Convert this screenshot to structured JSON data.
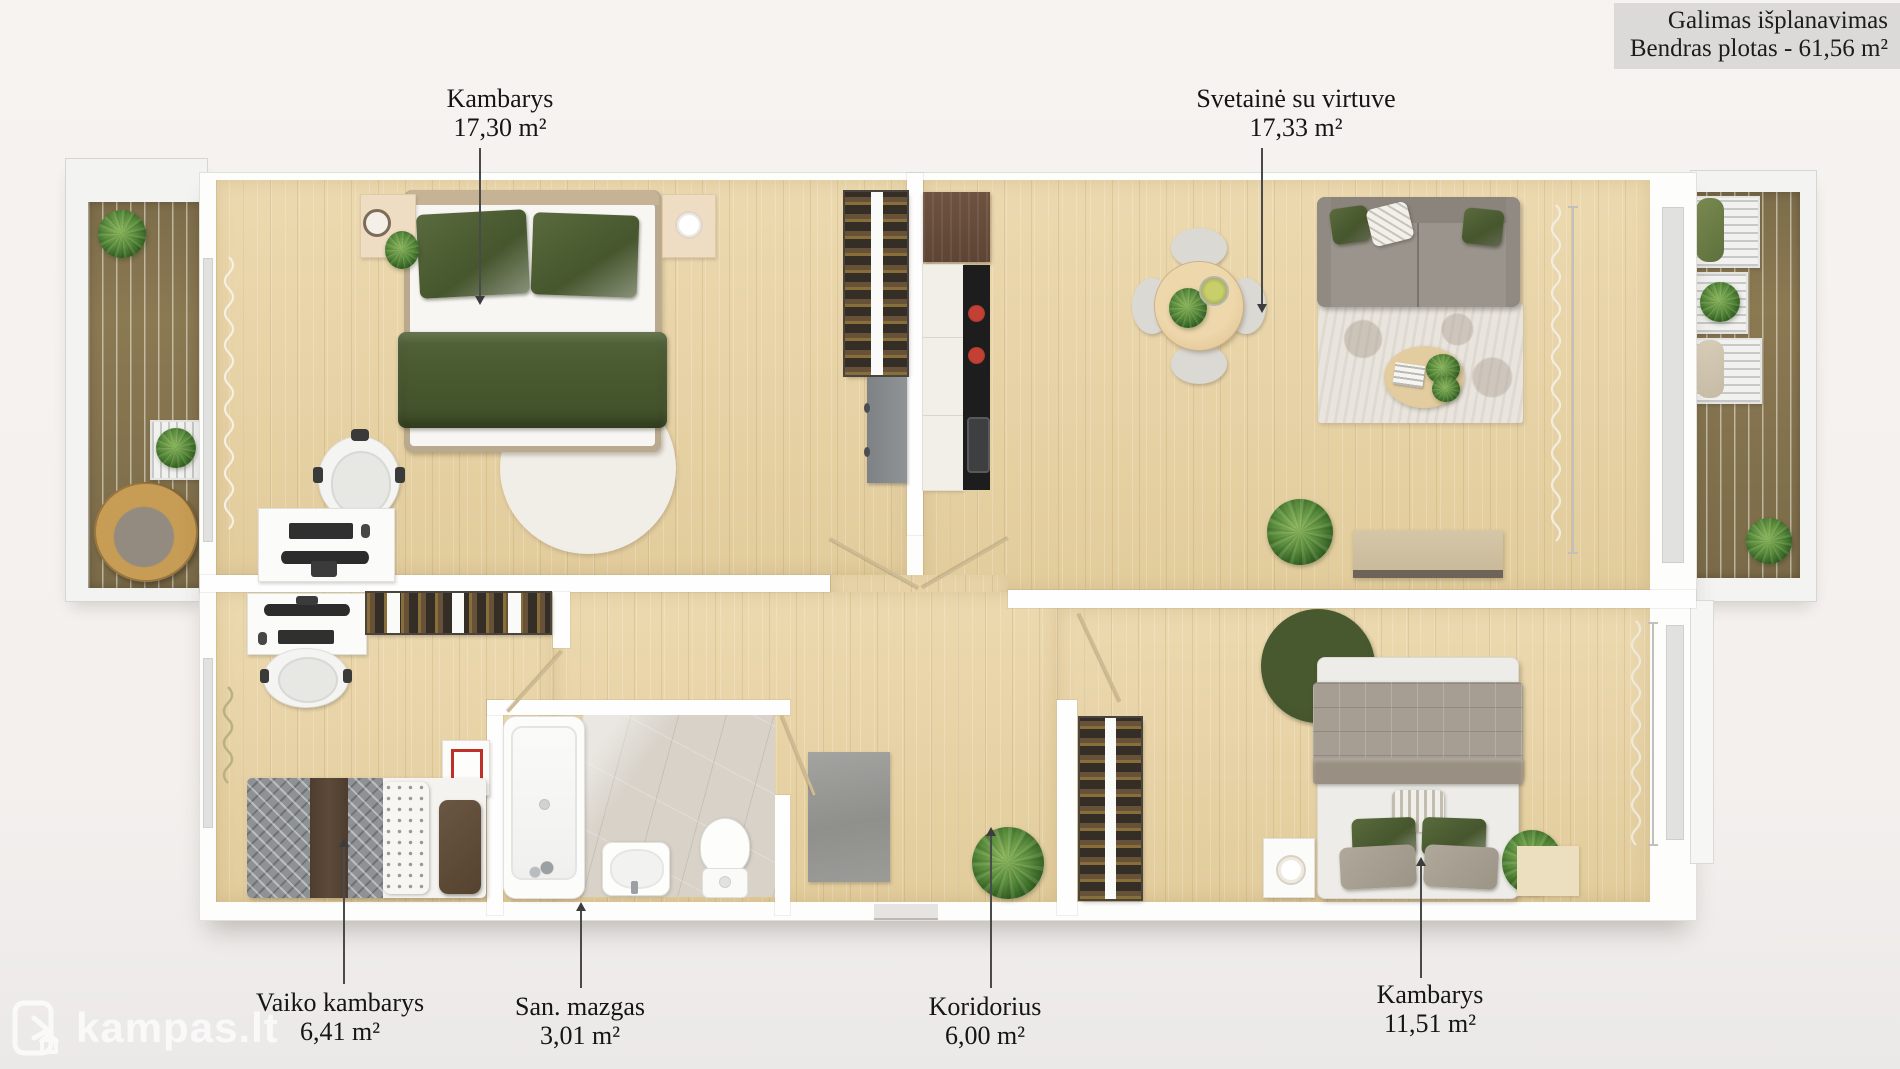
{
  "header": {
    "title_line1": "Galimas išplanavimas",
    "title_line2": "Bendras plotas - 61,56 m²"
  },
  "rooms": [
    {
      "name": "Kambarys",
      "area": "17,30 m²"
    },
    {
      "name": "Svetainė su virtuve",
      "area": "17,33 m²"
    },
    {
      "name": "Vaiko kambarys",
      "area": "6,41 m²"
    },
    {
      "name": "San. mazgas",
      "area": "3,01 m²"
    },
    {
      "name": "Koridorius",
      "area": "6,00 m²"
    },
    {
      "name": "Kambarys",
      "area": "11,51 m²"
    }
  ],
  "watermark": {
    "text": "kampas.lt"
  },
  "colors": {
    "background": "#f4f0ee",
    "wall": "#fefefe",
    "wood_floor": "#e8d4a8",
    "balcony_deck": "#8b7952",
    "accent_green": "#4e5e35",
    "title_box": "#dbdad8",
    "label_text": "#151515"
  }
}
